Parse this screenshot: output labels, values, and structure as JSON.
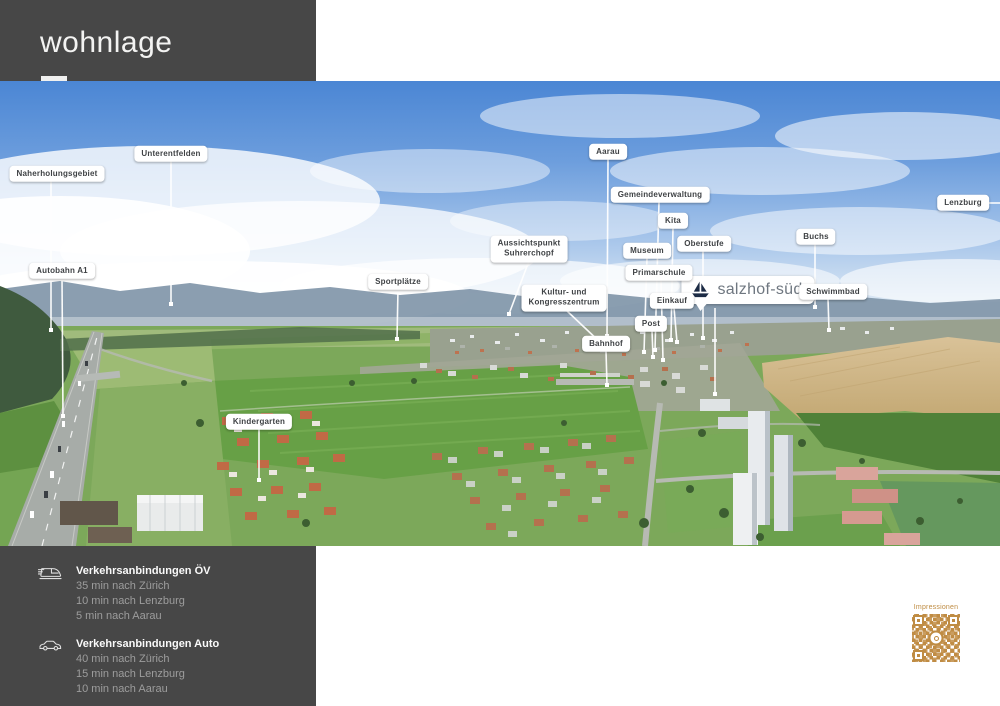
{
  "header": {
    "title": "wohnlage"
  },
  "map": {
    "brand": {
      "label": "salzhof-süd",
      "icon": "sailboat-icon",
      "x": 748,
      "y": 209,
      "line": {
        "x1": 715,
        "y1": 227,
        "x2": 715,
        "y2": 313
      }
    },
    "callouts": [
      {
        "label": "Naherholungsgebiet",
        "x": 57,
        "y": 93,
        "line": {
          "x1": 51,
          "y1": 100,
          "x2": 51,
          "y2": 249
        }
      },
      {
        "label": "Unterentfelden",
        "x": 171,
        "y": 73,
        "line": {
          "x1": 171,
          "y1": 80,
          "x2": 171,
          "y2": 223
        }
      },
      {
        "label": "Autobahn A1",
        "x": 62,
        "y": 190,
        "line": {
          "x1": 62,
          "y1": 197,
          "x2": 63,
          "y2": 335
        }
      },
      {
        "label": "Sportplätze",
        "x": 398,
        "y": 201,
        "line": {
          "x1": 398,
          "y1": 208,
          "x2": 397,
          "y2": 258
        }
      },
      {
        "label": "Aussichtspunkt\nSuhrerchopf",
        "x": 529,
        "y": 168,
        "multiline": true,
        "line": {
          "x1": 529,
          "y1": 180,
          "x2": 509,
          "y2": 233
        }
      },
      {
        "label": "Kultur- und\nKongresszentrum",
        "x": 564,
        "y": 217,
        "multiline": true,
        "line": {
          "x1": 566,
          "y1": 229,
          "x2": 603,
          "y2": 264
        }
      },
      {
        "label": "Bahnhof",
        "x": 606,
        "y": 263,
        "line": {
          "x1": 606,
          "y1": 270,
          "x2": 607,
          "y2": 304
        }
      },
      {
        "label": "Aarau",
        "x": 608,
        "y": 71,
        "line": {
          "x1": 608,
          "y1": 78,
          "x2": 607,
          "y2": 255
        }
      },
      {
        "label": "Gemeindeverwaltung",
        "x": 660,
        "y": 114,
        "line": {
          "x1": 659,
          "y1": 121,
          "x2": 655,
          "y2": 269
        }
      },
      {
        "label": "Kita",
        "x": 673,
        "y": 140,
        "line": {
          "x1": 673,
          "y1": 147,
          "x2": 671,
          "y2": 259
        }
      },
      {
        "label": "Museum",
        "x": 647,
        "y": 170,
        "line": {
          "x1": 647,
          "y1": 177,
          "x2": 644,
          "y2": 271
        }
      },
      {
        "label": "Primarschule",
        "x": 659,
        "y": 192,
        "line": {
          "x1": 661,
          "y1": 199,
          "x2": 663,
          "y2": 279
        }
      },
      {
        "label": "Einkauf",
        "x": 672,
        "y": 220,
        "line": {
          "x1": 674,
          "y1": 227,
          "x2": 677,
          "y2": 261
        }
      },
      {
        "label": "Post",
        "x": 651,
        "y": 243,
        "line": {
          "x1": 652,
          "y1": 250,
          "x2": 653,
          "y2": 276
        }
      },
      {
        "label": "Oberstufe",
        "x": 704,
        "y": 163,
        "line": {
          "x1": 703,
          "y1": 170,
          "x2": 703,
          "y2": 257
        }
      },
      {
        "label": "Schwimmbad",
        "x": 833,
        "y": 211,
        "line": {
          "x1": 828,
          "y1": 218,
          "x2": 829,
          "y2": 249
        }
      },
      {
        "label": "Buchs",
        "x": 816,
        "y": 156,
        "line": {
          "x1": 815,
          "y1": 163,
          "x2": 815,
          "y2": 226
        }
      },
      {
        "label": "Lenzburg",
        "x": 963,
        "y": 122,
        "dot": false,
        "line": {
          "x1": 989,
          "y1": 122,
          "x2": 1000,
          "y2": 122
        }
      },
      {
        "label": "Kindergarten",
        "x": 259,
        "y": 341,
        "line": {
          "x1": 259,
          "y1": 348,
          "x2": 259,
          "y2": 399
        }
      }
    ]
  },
  "footer": {
    "sections": [
      {
        "icon": "train-icon",
        "title": "Verkehrsanbindungen ÖV",
        "lines": [
          "35 min nach Zürich",
          "10 min nach Lenzburg",
          "5 min nach Aarau"
        ]
      },
      {
        "icon": "car-icon",
        "title": "Verkehrsanbindungen Auto",
        "lines": [
          "40 min nach Zürich",
          "15 min nach Lenzburg",
          "10 min nach Aarau"
        ]
      }
    ]
  },
  "qr": {
    "label": "Impressionen",
    "color": "#bf8c43"
  },
  "colors": {
    "header_bg": "#474747",
    "accent_orange": "#bf8c43",
    "callout_text": "#3f4245",
    "brand_navy": "#1c2b45",
    "brand_text": "#6f7780",
    "line_white": "#ffffff"
  }
}
